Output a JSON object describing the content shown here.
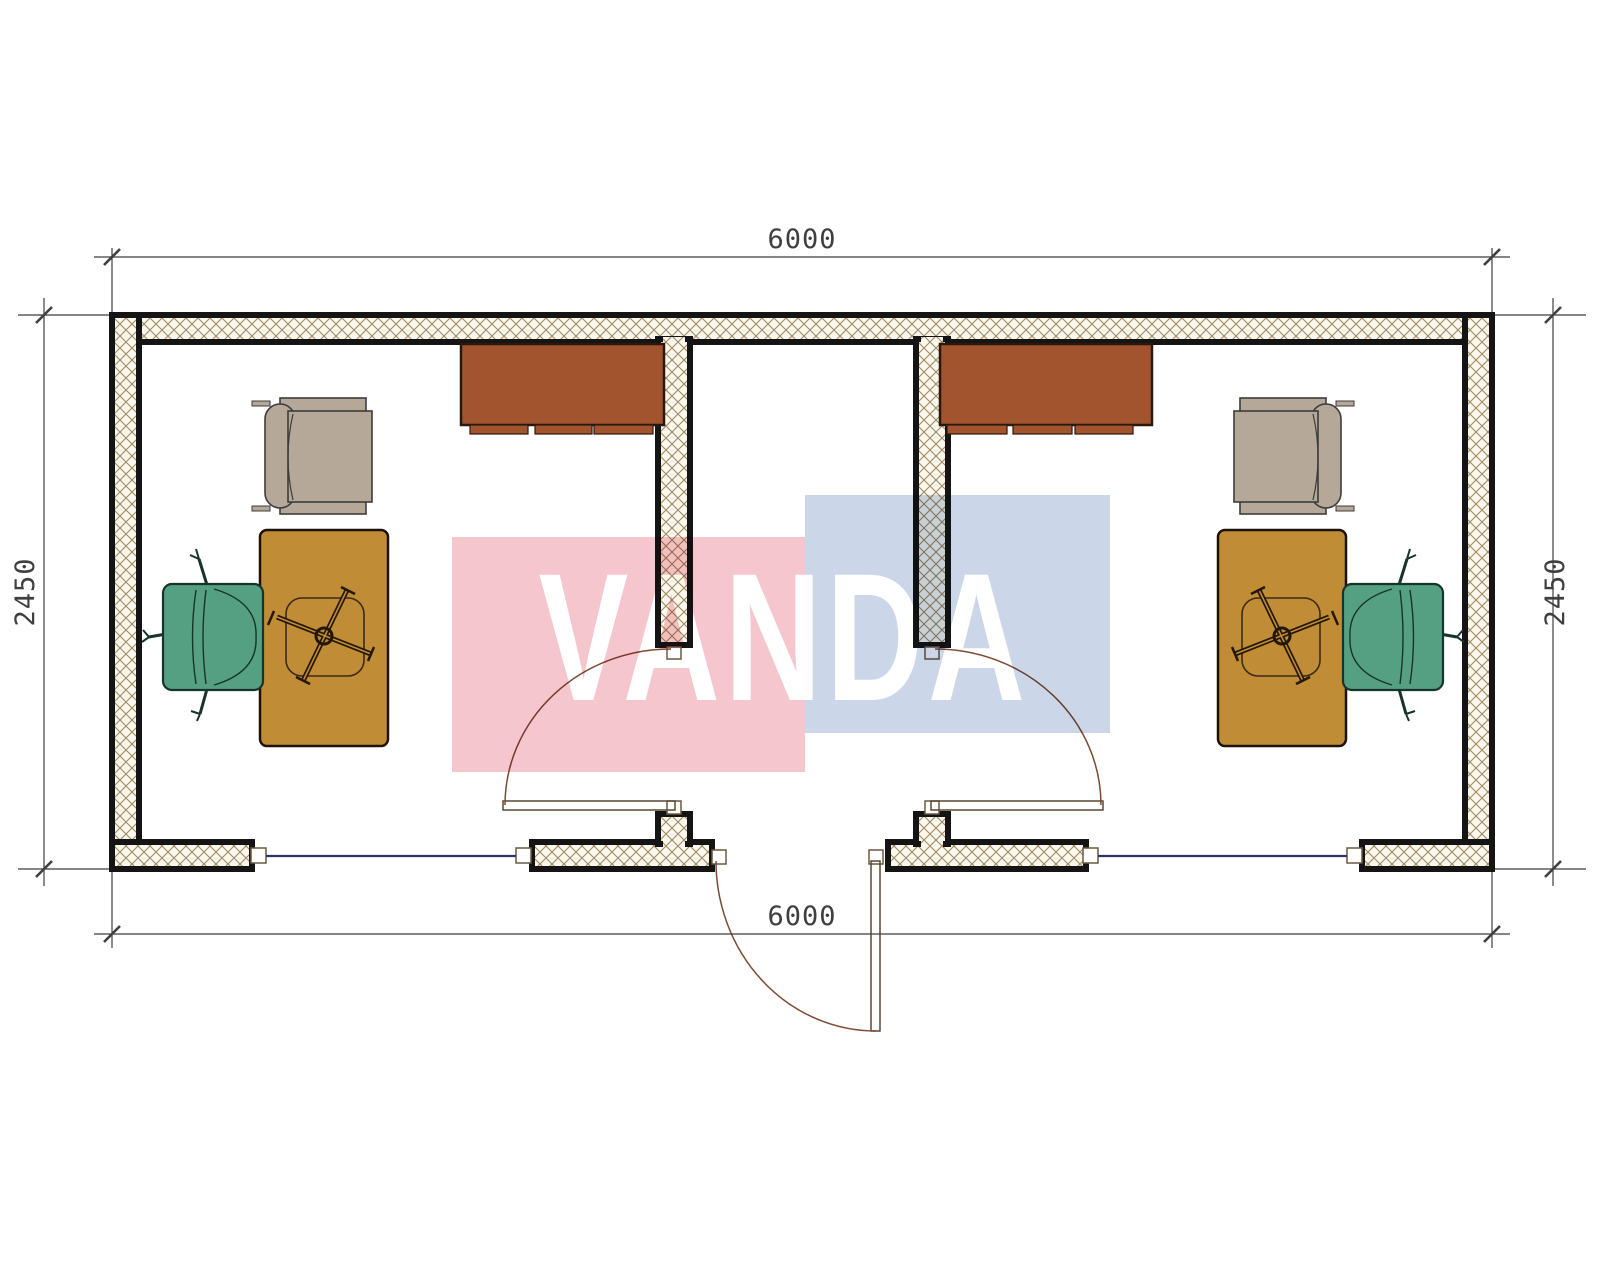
{
  "drawing": {
    "brand": "VANDA",
    "type": "floor-plan",
    "dimensions": {
      "top": "6000",
      "bottom": "6000",
      "left": "2450",
      "right": "2450"
    },
    "colors": {
      "wall_outline": "#141414",
      "wall_hatch_line": "#9d8a64",
      "wall_hatch_bg": "#fbf7ec",
      "dimension_line": "#3f3f3f",
      "window_glass": "#2e3566",
      "door_arc": "#7d4a33",
      "cabinet": "#a2542e",
      "desk": "#c08c35",
      "armchair": "#b6a898",
      "office_chair_green": "#55a083",
      "watermark_pink": "#f5c6cd",
      "watermark_blue": "#cbd7e8",
      "watermark_text": "#ffffff"
    },
    "rooms": [
      {
        "name": "left-office",
        "furniture": [
          "wall-cabinet",
          "armchair",
          "desk",
          "task-chair-cross-base",
          "office-chair"
        ]
      },
      {
        "name": "right-office",
        "furniture": [
          "wall-cabinet",
          "armchair",
          "desk",
          "task-chair-cross-base",
          "office-chair"
        ]
      }
    ],
    "openings": [
      "entrance-door-center",
      "interior-door-left",
      "interior-door-right",
      "window-left",
      "window-right"
    ]
  }
}
